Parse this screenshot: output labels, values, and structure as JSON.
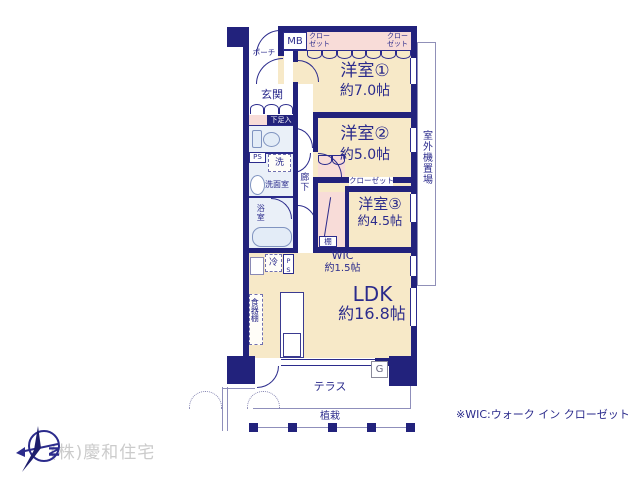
{
  "plan": {
    "rooms": {
      "room1": {
        "name": "洋室①",
        "size": "約7.0帖"
      },
      "room2": {
        "name": "洋室②",
        "size": "約5.0帖"
      },
      "room3": {
        "name": "洋室③",
        "size": "約4.5帖"
      },
      "ldk": {
        "name": "LDK",
        "size": "約16.8帖"
      },
      "wic": {
        "name": "WIC",
        "size": "約1.5帖"
      },
      "genkan": {
        "name": "玄関"
      }
    },
    "labels": {
      "porch": "ポーチ",
      "mb": "MB",
      "closet": "クローゼット",
      "closet_leader": "クローゼット",
      "shoe_box": "下足入",
      "ps": "PS",
      "washer": "洗",
      "washroom": "洗面室",
      "bathroom": "浴室",
      "corridor": "廊下",
      "fridge": "冷",
      "shelf": "棚",
      "dish_shelf": "食器棚",
      "terrace": "テラス",
      "planting": "植栽",
      "outdoor_unit": "室外機置場",
      "water_heater": "G"
    },
    "note": "※WIC:ウォーク イン クローゼット",
    "company": "(株)慶和住宅",
    "compass_letter": "N",
    "colors": {
      "wall": "#22227c",
      "text": "#2b2b8c",
      "room_fill": "#f7e9c8",
      "closet_fill": "#f8dcd8",
      "wet_fill": "#eaf0f8",
      "watermark": "#cbcbcb"
    }
  }
}
